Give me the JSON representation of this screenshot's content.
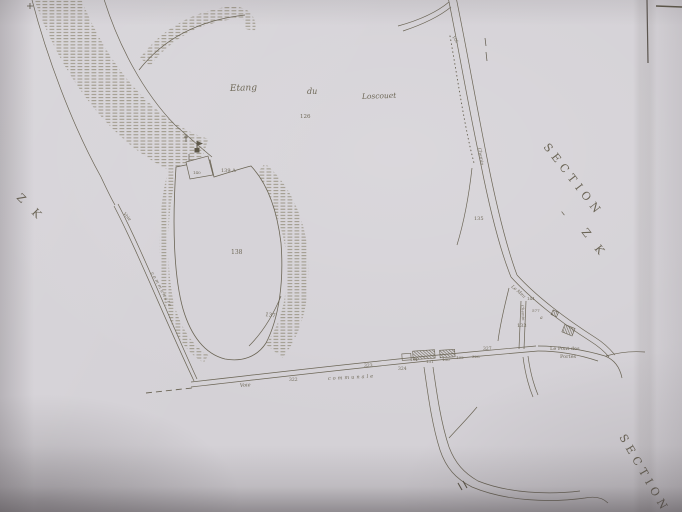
{
  "place_labels": {
    "etang_word1": "Etang",
    "etang_word2": "du",
    "etang_word3": "Loscouet",
    "pont_line1": "Le  Pont des",
    "pont_line2": "Portes",
    "stream": "Le Meu"
  },
  "section_labels": {
    "left_zk": "Z K",
    "right_section": "SECTION",
    "right_dash": "–",
    "right_zk": "Z K",
    "bottom_section": "SECTION"
  },
  "road_labels": {
    "bottom_voie": "Voie",
    "bottom_communale": "communale",
    "left_voie": "Voie",
    "left_communale": "communale",
    "right_chemin": "Chemin",
    "village_chemin": "Chemin"
  },
  "parcel_numbers": {
    "n126": "126",
    "n140": "140",
    "n139a": "139 A",
    "n138": "138",
    "n137": "137",
    "n135": "135",
    "n134": "134",
    "n133": "133",
    "n144": "144",
    "n577": "577",
    "na": "a",
    "n130": "130",
    "n131": "131",
    "n132": "132",
    "n322": "322",
    "n323": "323",
    "n324": "324",
    "n327": "327",
    "n328": "328",
    "n105": "105"
  },
  "colors": {
    "paper": "#d4d1d6",
    "ink": "#6b6555",
    "hachure": "#96907e",
    "photo_shadow": "#3e383c"
  }
}
